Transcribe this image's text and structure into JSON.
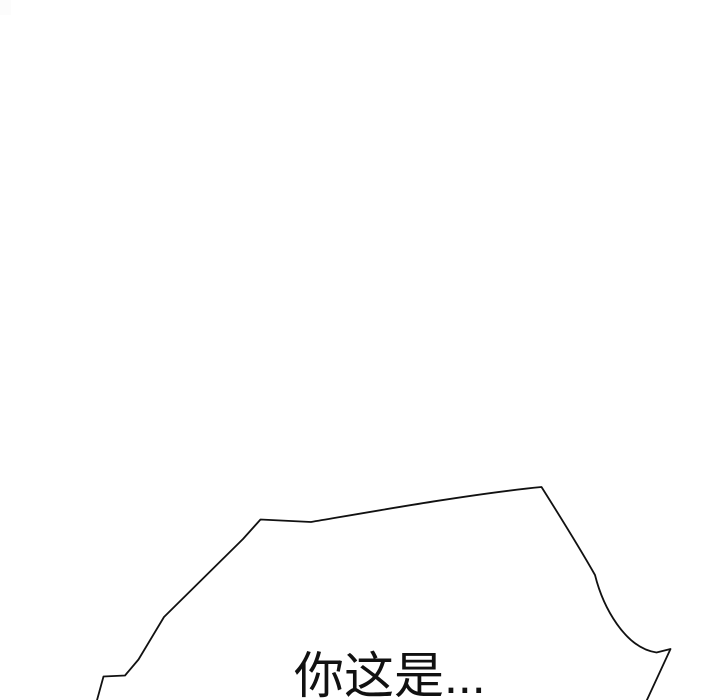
{
  "panel": {
    "background_color": "#ffffff",
    "ink_color": "#111111",
    "speech_bubble": {
      "text": "你这是...",
      "outline_path": "M 96.5 702 L 103.5 676.5 L 125 675.5 L 138.5 659.5 L 164 617 L 243 539 L 260.5 519.5 L 311 522 C 370 512 470 494 541.5 487 C 556 510 578 545 595 575 C 603 607 625 648 656.5 652.5 L 670.5 649 L 646 702"
    }
  }
}
